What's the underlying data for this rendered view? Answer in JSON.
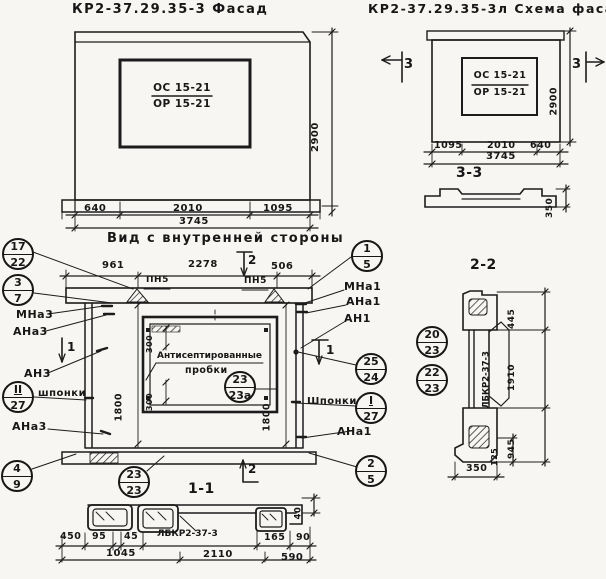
{
  "titles": {
    "facade": "КР2-37.29.35-3 Фасад",
    "schema": "КР2-37.29.35-3л Схема фасада",
    "inner_view": "Вид с внутренней стороны",
    "sec33": "3-3",
    "sec22": "2-2",
    "sec11": "1-1"
  },
  "facade": {
    "mark1": "ОС 15-21",
    "mark2": "ОР 15-21",
    "d640": "640",
    "d2010": "2010",
    "d1095": "1095",
    "d3745": "3745",
    "d2900": "2900"
  },
  "schema": {
    "mark1": "ОС 15-21",
    "mark2": "ОР 15-21",
    "d1095": "1095",
    "d2010": "2010",
    "d640": "640",
    "d3745": "3745",
    "d2900": "2900",
    "cut3": "3",
    "d350": "350"
  },
  "inner": {
    "d961": "961",
    "d2278": "2278",
    "d506": "506",
    "pn5": "ПН5",
    "cut2": "2",
    "cut1": "1",
    "d1800": "1800",
    "d300": "300",
    "note1": "Антисептированные",
    "note2": "пробки",
    "shponki_l": "шпонки",
    "shponki_r": "Шпонки",
    "mna3": "МНа3",
    "ana3": "АНа3",
    "an3": "АН3",
    "mna1": "МНа1",
    "ana1": "АНа1",
    "an1": "АН1"
  },
  "callouts": {
    "k17_22": {
      "t": "17",
      "b": "22"
    },
    "k3_7": {
      "t": "3",
      "b": "7"
    },
    "k2_27": {
      "t": "II",
      "b": "27"
    },
    "k4_9": {
      "t": "4",
      "b": "9"
    },
    "k1_5": {
      "t": "1",
      "b": "5"
    },
    "k25_24": {
      "t": "25",
      "b": "24"
    },
    "k1_27": {
      "t": "I",
      "b": "27"
    },
    "k2_5": {
      "t": "2",
      "b": "5"
    },
    "k23_23a": {
      "t": "23",
      "b": "23а"
    },
    "k23_23": {
      "t": "23",
      "b": "23"
    },
    "k20_23": {
      "t": "20",
      "b": "23"
    },
    "k22_23": {
      "t": "22",
      "b": "23"
    }
  },
  "sec11": {
    "mark": "ЛБКР2-37-3",
    "d450": "450",
    "d95": "95",
    "d45": "45",
    "d1045": "1045",
    "d2110": "2110",
    "d165": "165",
    "d90": "90",
    "d590": "590",
    "d40": "40"
  },
  "sec22": {
    "mark": "ЛБКР2-37-3",
    "d445": "445",
    "d1910": "1910",
    "d945": "945",
    "d125": "125",
    "d350": "350"
  }
}
